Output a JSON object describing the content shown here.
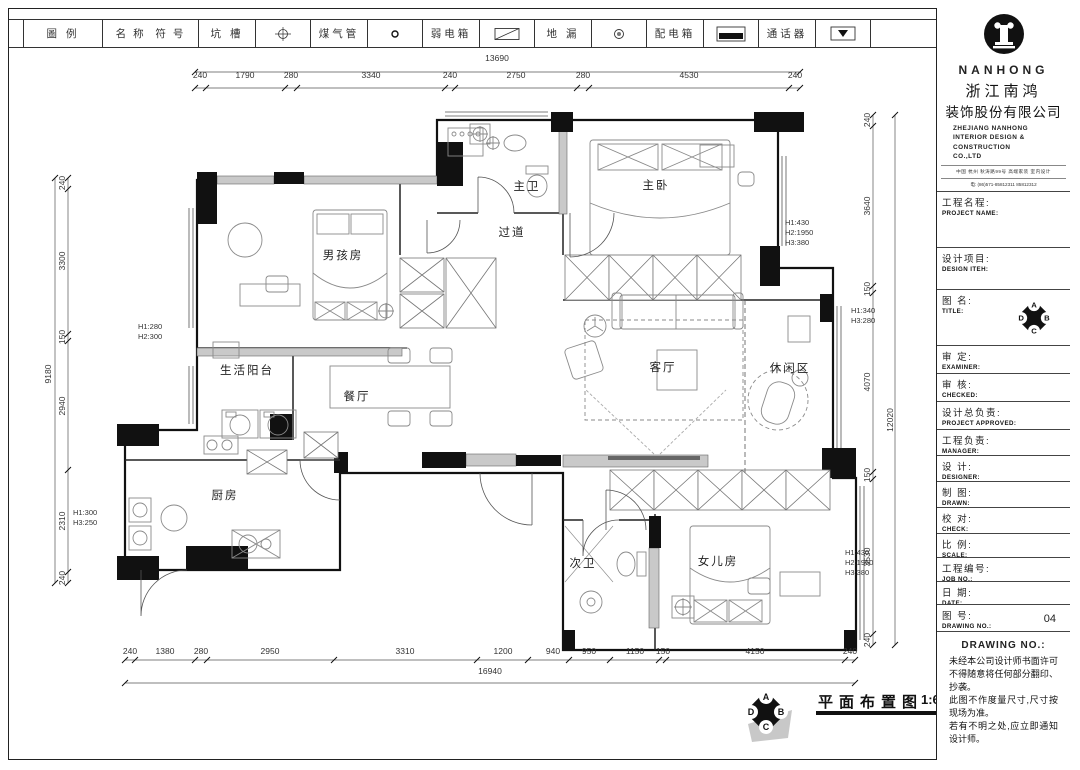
{
  "legend": {
    "labels": [
      "圖 例",
      "名 称",
      "符 号",
      "坑 槽",
      "煤气管",
      "弱电箱",
      "地 漏",
      "配电箱",
      "通话器"
    ]
  },
  "title_block": {
    "brand": {
      "name_en": "NANHONG",
      "cn_line1": "浙江南鸿",
      "cn_line2": "装饰股份有限公司",
      "en_lines": [
        "ZHEJIANG NANHONG",
        "INTERIOR DESIGN &",
        "CONSTRUCTION",
        "CO.,LTD"
      ],
      "tagline": "中国 杭州 秋涛路99号 高端家装 室内设计",
      "phone": "电: (86)571-85812311 85812312"
    },
    "fields": [
      {
        "cn": "工程名程:",
        "en": "PROJECT NAME:"
      },
      {
        "cn": "设计项目:",
        "en": "DESIGN ITEH:"
      },
      {
        "cn": "图  名:",
        "en": "TITLE:"
      },
      {
        "cn": "审  定:",
        "en": "EXAMINER:"
      },
      {
        "cn": "审  核:",
        "en": "CHECKED:"
      },
      {
        "cn": "设计总负责:",
        "en": "PROJECT APPROVED:"
      },
      {
        "cn": "工程负责:",
        "en": "MANAGER:"
      },
      {
        "cn": "设  计:",
        "en": "DESIGNER:"
      },
      {
        "cn": "制  图:",
        "en": "DRAWN:"
      },
      {
        "cn": "校  对:",
        "en": "CHECK:"
      },
      {
        "cn": "比  例:",
        "en": "SCALE:"
      },
      {
        "cn": "工程编号:",
        "en": "JOB NO.:"
      },
      {
        "cn": "日  期:",
        "en": "DATE:"
      },
      {
        "cn": "图  号:",
        "en": "DRAWING NO.:",
        "value": "04"
      }
    ],
    "notes_title": "DRAWING NO.:",
    "notes": [
      "未经本公司设计师书面许可不得随意将任何部分翻印、抄袭。",
      "此图不作度量尺寸,尺寸按现场为准。",
      "若有不明之处,应立即通知设计师。"
    ]
  },
  "plan": {
    "rooms": [
      "主卧",
      "主卫",
      "过道",
      "男孩房",
      "生活阳台",
      "餐厅",
      "客厅",
      "休闲区",
      "厨房",
      "次卫",
      "女儿房"
    ],
    "height_notes": [
      "H1:280\nH2:300",
      "H1:300\nH3:250",
      "H1:430\nH2:1950\nH3:380",
      "H1:340\nH3:280",
      "H1:430\nH2:1950\nH3:380"
    ],
    "dims": {
      "top": {
        "total": "13690",
        "segments": [
          "240",
          "1790",
          "280",
          "3340",
          "240",
          "2750",
          "280",
          "4530",
          "240"
        ]
      },
      "bottom": {
        "total": "16940",
        "segments": [
          "240",
          "1380",
          "280",
          "2950",
          "3310",
          "1200",
          "940",
          "950",
          "1150",
          "150",
          "4150",
          "240"
        ]
      },
      "left": {
        "total": "9180",
        "segments": [
          "240",
          "3300",
          "150",
          "2940",
          "2310",
          "240"
        ]
      },
      "right": {
        "total": "12020",
        "segments": [
          "240",
          "3640",
          "150",
          "4070",
          "150",
          "3530",
          "240"
        ]
      }
    }
  },
  "footer": {
    "title": "平面布置图",
    "scale": "1:60",
    "compass": [
      "A",
      "B",
      "C",
      "D"
    ]
  }
}
